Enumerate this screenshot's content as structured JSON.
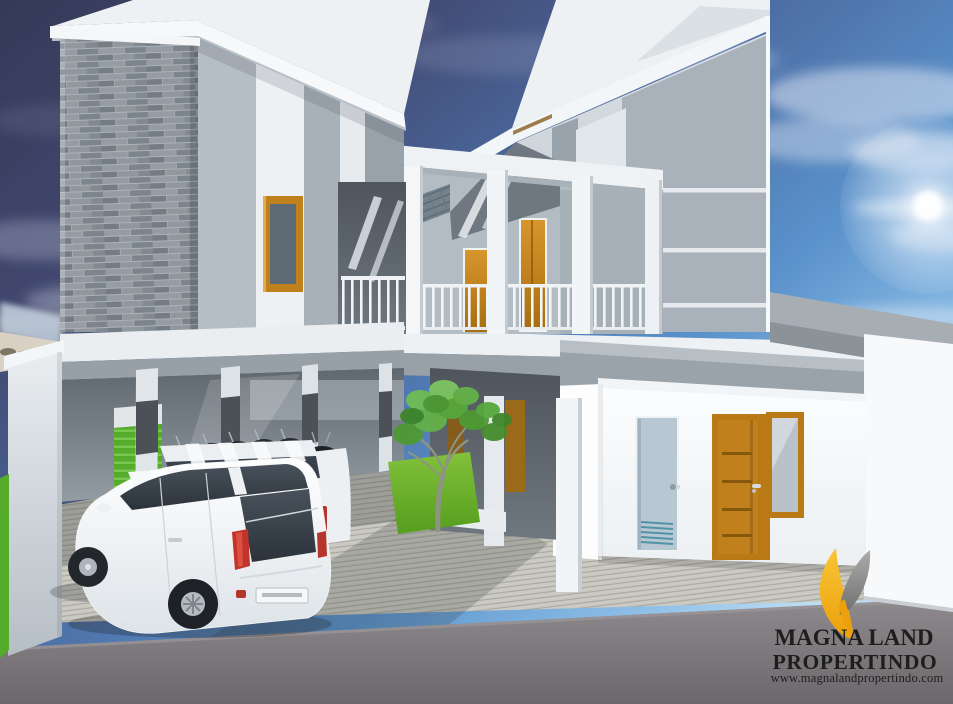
{
  "image_alt": "3D exterior rendering of a modern two-storey townhouse complex: stacked-stone accent column, wood-framed doors and windows, central walkway with white columns and balcony railings, ground-floor carport with two white MPV cars and parked motorcycles, frangipani tree on a grass bed, striped concrete paving and asphalt road under a blue sky with sun glare",
  "branding": {
    "company_line1": "MAGNA LAND",
    "company_line2": "PROPERTINDO",
    "website": "www.magnalandpropertindo.com"
  },
  "colors": {
    "sky_top": "#373b5a",
    "sky_mid": "#4c6ea6",
    "sky_horizon": "#b9dcf2",
    "building_white": "#f2f5f7",
    "wall_light_gray": "#ccd3d9",
    "wall_medium_gray": "#a8b1b8",
    "wall_dark_gray": "#4b5157",
    "stone_gray": "#8f979d",
    "wood_orange": "#c0811c",
    "window_glass": "#5e6b75",
    "utility_door_blue": "#b7c8d3",
    "green_accent": "#55ab2a",
    "grass_green": "#6fae27",
    "foliage_green": "#4e9a33",
    "pavement_gray": "#cac9c2",
    "road_gray": "#7b777b",
    "car_white": "#f1f4f6",
    "taillight_red": "#c23329",
    "logo_yellow": "#f2af1d",
    "logo_gray": "#8f8f8f",
    "logo_text": "#1d1d1d"
  },
  "scene": {
    "objects": [
      "two-storey townhouse block (left)",
      "two-storey townhouse block (right)",
      "stacked-stone accent column",
      "central walkway with white columns and railings",
      "wood-framed windows and doors",
      "light-blue utility door with vent slats",
      "ground-floor carport",
      "white MPV car (foreground)",
      "white MPV car (background)",
      "row of parked motorcycles",
      "frangipani tree on grass bed",
      "green accent walls",
      "striped concrete paving",
      "asphalt road",
      "developer logo"
    ]
  }
}
